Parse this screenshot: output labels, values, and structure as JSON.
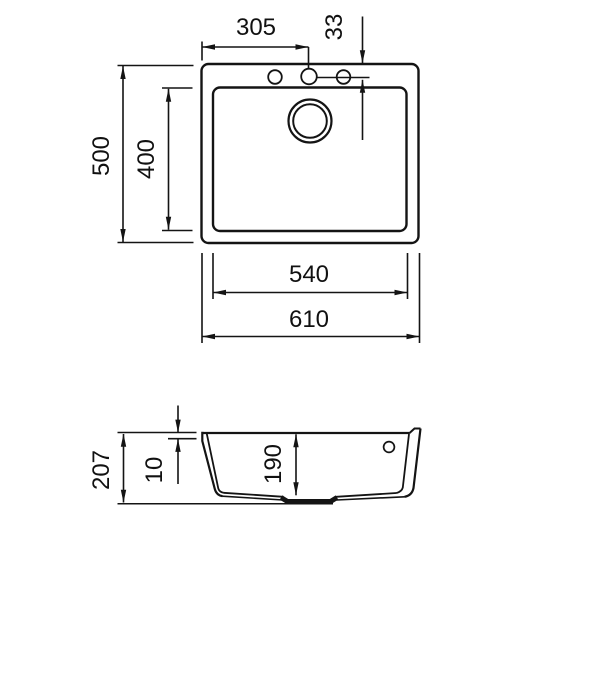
{
  "drawing": {
    "kind": "sink technical drawing",
    "background": "#ffffff",
    "line_color": "#141414",
    "views": {
      "top_view": "plan view of sink",
      "section_view": "cross-section of sink"
    },
    "dimensions": {
      "faucet_hole_offset": "305",
      "faucet_hole_setback": "33",
      "overall_depth": "500",
      "bowl_depth": "400",
      "bowl_width": "540",
      "overall_width": "610",
      "section_height": "207",
      "rim_height": "10",
      "bowl_height": "190"
    }
  }
}
